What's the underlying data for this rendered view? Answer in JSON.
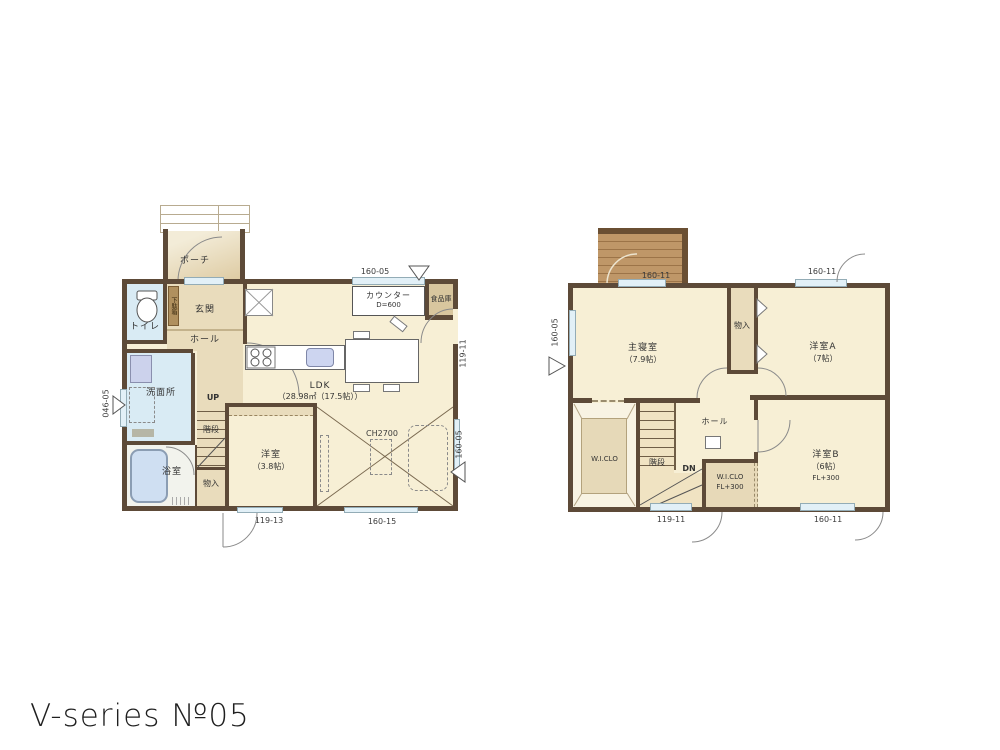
{
  "title": "V-series №05",
  "colors": {
    "wall": "#5d4a38",
    "floor_cream": "#f7efd5",
    "floor_tan": "#e9dcbc",
    "wet_blue": "#d9ebf4",
    "balcony_wood": "#bf9768",
    "window": "#e2f0f7"
  },
  "f1": {
    "porch": "ポーチ",
    "genkan": "玄関",
    "shoebox": "下駄箱",
    "toilet": "トイレ",
    "hall": "ホール",
    "wash": "洗面所",
    "bath": "浴室",
    "up": "UP",
    "stairs": "階段",
    "storage": "物入",
    "west": "洋室",
    "west_size": "（3.8帖）",
    "ldk": "LDK",
    "ldk_size": "（28.98㎡（17.5帖））",
    "counter": "カウンター",
    "counter_d": "D=600",
    "pantry": "食品庫",
    "ch": "CH2700",
    "dim_top": "160-05",
    "dim_right_up": "119-11",
    "dim_right_low": "160-05",
    "dim_left": "046-05",
    "dim_bl": "119-13",
    "dim_br": "160-15"
  },
  "f2": {
    "master": "主寝室",
    "master_size": "（7.9帖）",
    "closet": "物入",
    "room_a": "洋室A",
    "room_a_size": "（7帖）",
    "hall": "ホール",
    "wic": "W.I.CLO",
    "stairs": "階段",
    "dn": "DN",
    "wic2": "W.I.CLO",
    "wic2_fl": "FL+300",
    "room_b": "洋室B",
    "room_b_size": "（6帖）",
    "room_b_fl": "FL+300",
    "dim_tl": "160-11",
    "dim_tr": "160-11",
    "dim_left": "160-05",
    "dim_bl": "119-11",
    "dim_br": "160-11"
  }
}
